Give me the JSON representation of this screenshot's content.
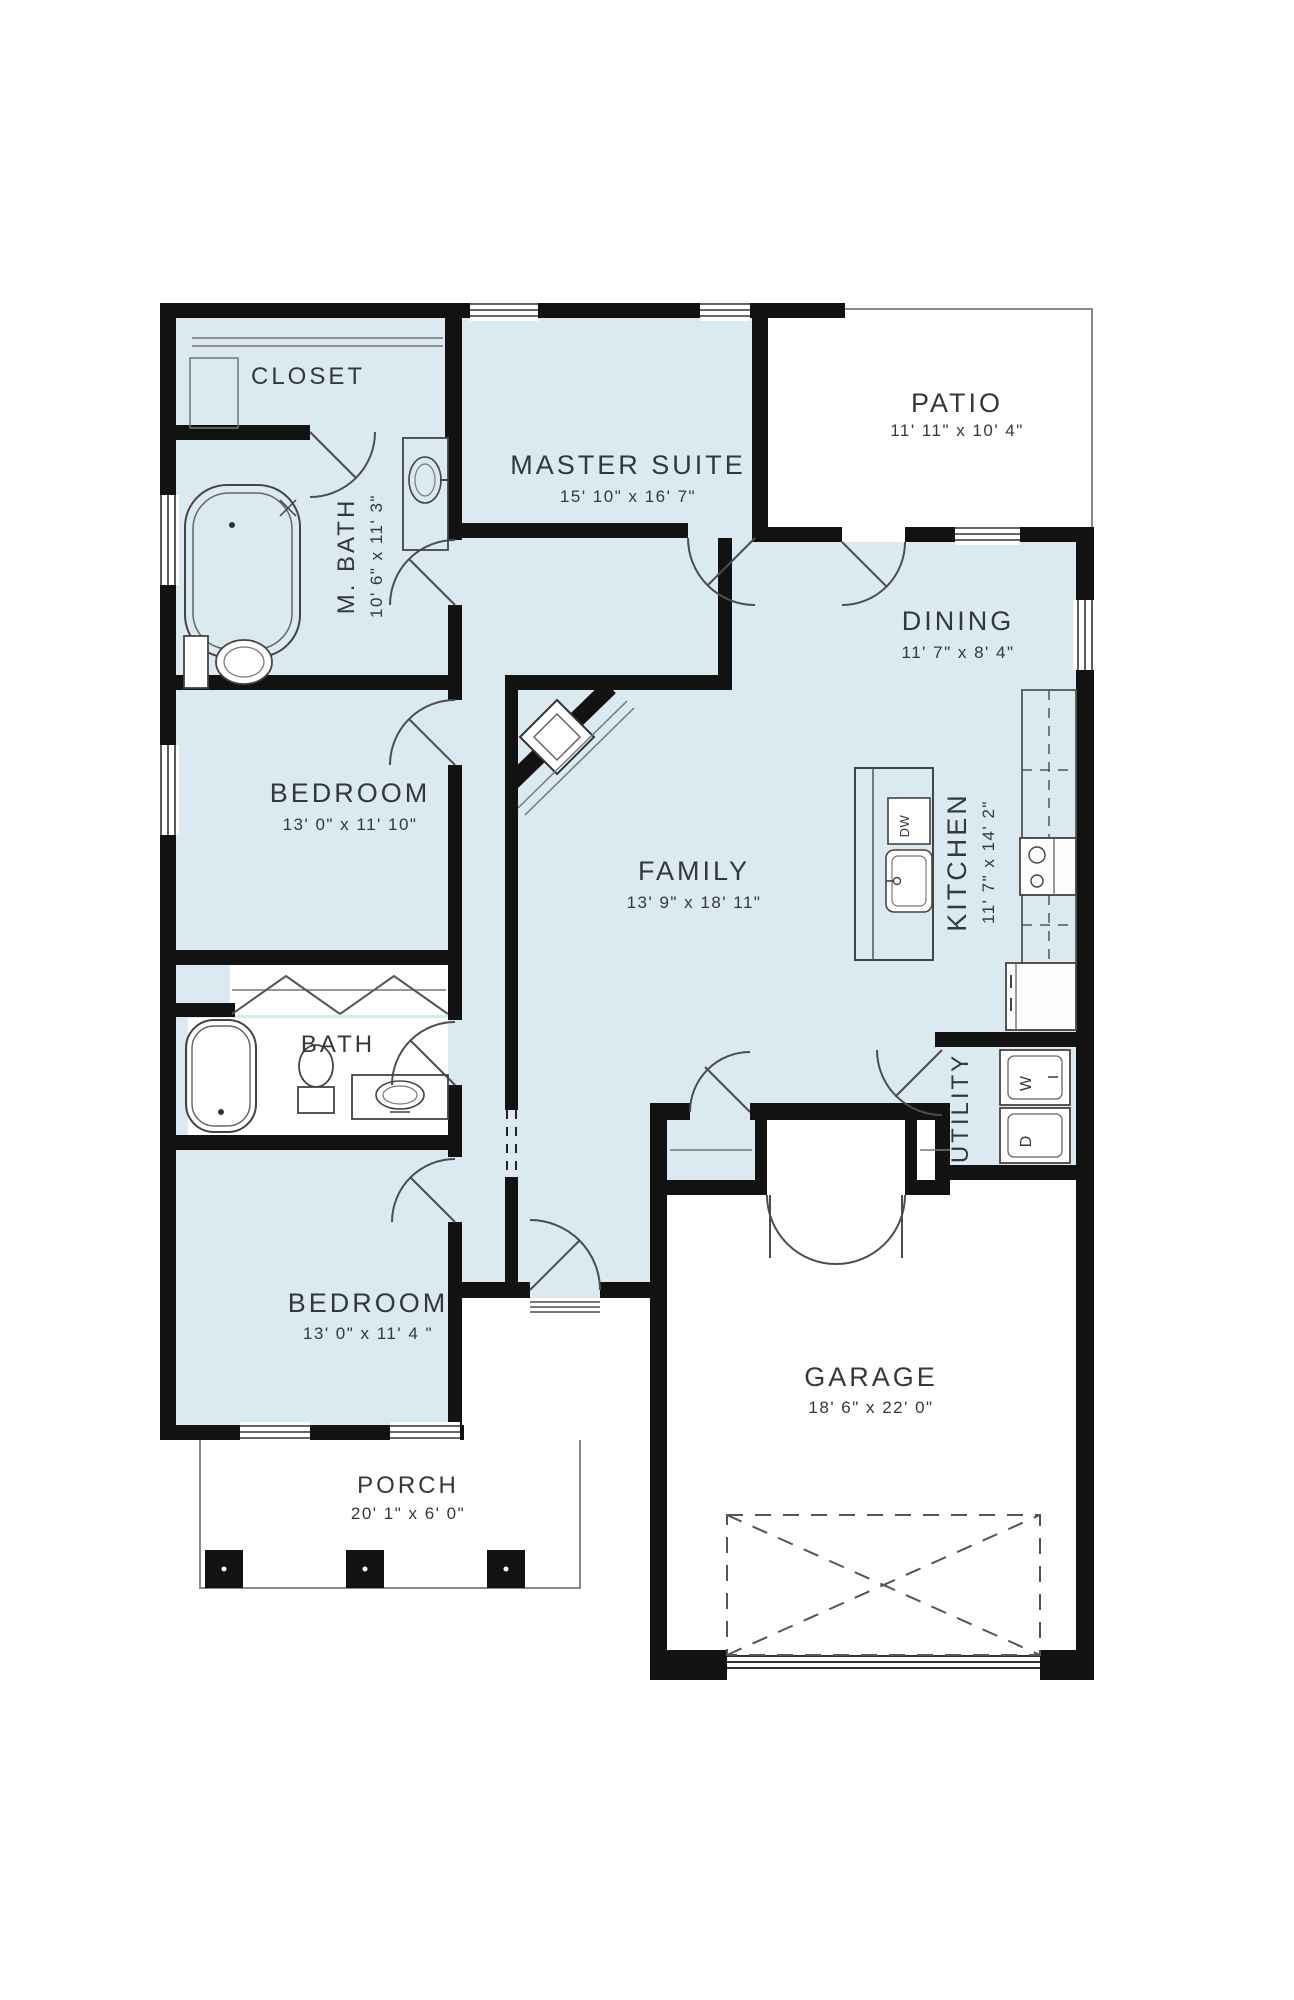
{
  "plan": {
    "type": "residential-floor-plan",
    "colors": {
      "room_fill": "#dbe9f1",
      "wall": "#121212",
      "thin_line": "#4d4d4d",
      "label": "#34383c",
      "exterior_fill": "#ffffff"
    },
    "rooms": {
      "closet": {
        "name": "CLOSET",
        "dims": ""
      },
      "master_bath": {
        "name": "M. BATH",
        "dims": "10' 6\" x 11' 3\""
      },
      "master_suite": {
        "name": "MASTER SUITE",
        "dims": "15' 10\" x 16' 7\""
      },
      "patio": {
        "name": "PATIO",
        "dims": "11' 11\" x 10' 4\""
      },
      "dining": {
        "name": "DINING",
        "dims": "11' 7\" x 8' 4\""
      },
      "bedroom_upper": {
        "name": "BEDROOM",
        "dims": "13' 0\" x 11' 10\""
      },
      "family": {
        "name": "FAMILY",
        "dims": "13' 9\" x 18' 11\""
      },
      "kitchen": {
        "name": "KITCHEN",
        "dims": "11' 7\" x 14' 2\""
      },
      "bath": {
        "name": "BATH",
        "dims": ""
      },
      "utility": {
        "name": "UTILITY",
        "dims": ""
      },
      "bedroom_lower": {
        "name": "BEDROOM",
        "dims": "13' 0\" x 11' 4 \""
      },
      "garage": {
        "name": "GARAGE",
        "dims": "18' 6\" x 22' 0\""
      },
      "porch": {
        "name": "PORCH",
        "dims": "20' 1\" x 6' 0\""
      }
    },
    "appliances": {
      "washer": "W",
      "dryer": "D",
      "dishwasher": "DW"
    }
  }
}
